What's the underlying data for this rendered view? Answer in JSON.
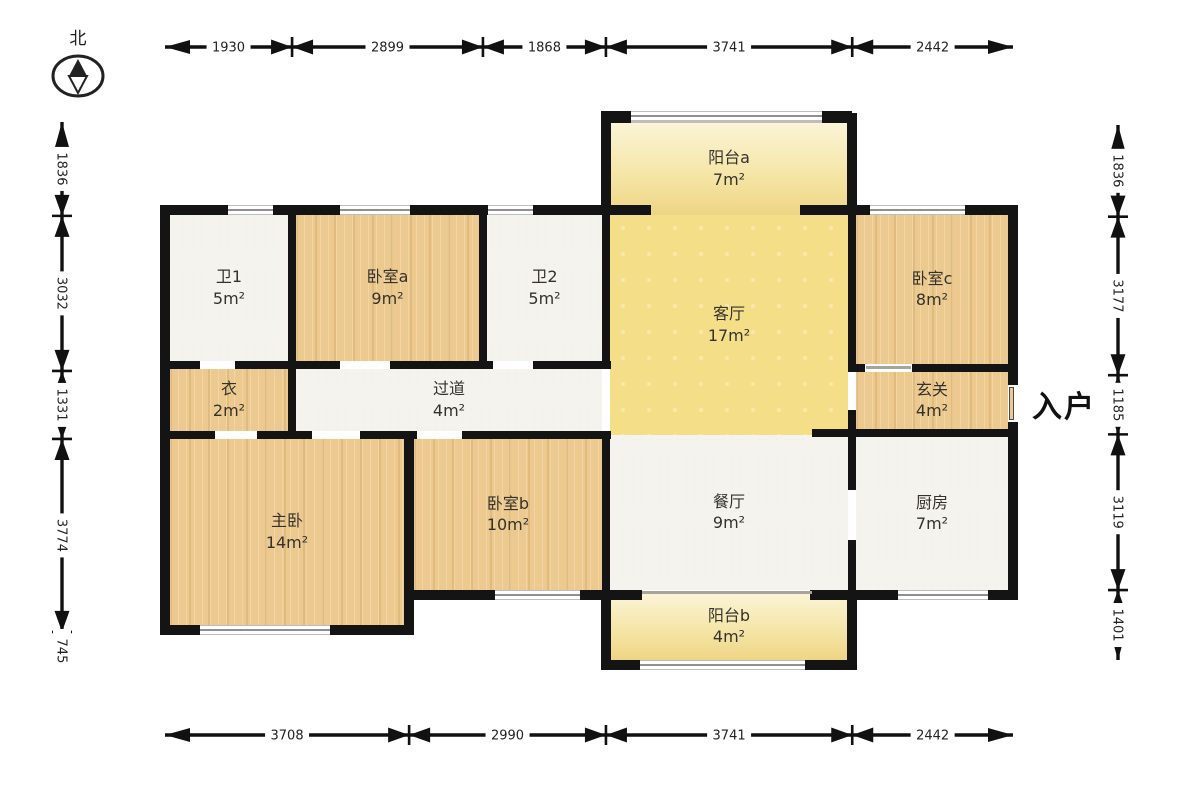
{
  "compass": {
    "label": "北"
  },
  "entry_label": "入户",
  "rooms": [
    {
      "id": "balcony-a",
      "name": "阳台a",
      "area": "7m²",
      "floor": "balcony"
    },
    {
      "id": "bath-1",
      "name": "卫1",
      "area": "5m²",
      "floor": "tile"
    },
    {
      "id": "bedroom-a",
      "name": "卧室a",
      "area": "9m²",
      "floor": "wood"
    },
    {
      "id": "bath-2",
      "name": "卫2",
      "area": "5m²",
      "floor": "tile"
    },
    {
      "id": "living-room",
      "name": "客厅",
      "area": "17m²",
      "floor": "living"
    },
    {
      "id": "bedroom-c",
      "name": "卧室c",
      "area": "8m²",
      "floor": "wood"
    },
    {
      "id": "closet",
      "name": "衣",
      "area": "2m²",
      "floor": "wood"
    },
    {
      "id": "hallway",
      "name": "过道",
      "area": "4m²",
      "floor": "tile"
    },
    {
      "id": "entry-hall",
      "name": "玄关",
      "area": "4m²",
      "floor": "wood"
    },
    {
      "id": "master-bedroom",
      "name": "主卧",
      "area": "14m²",
      "floor": "wood"
    },
    {
      "id": "bedroom-b",
      "name": "卧室b",
      "area": "10m²",
      "floor": "wood"
    },
    {
      "id": "dining-room",
      "name": "餐厅",
      "area": "9m²",
      "floor": "tile"
    },
    {
      "id": "kitchen",
      "name": "厨房",
      "area": "7m²",
      "floor": "tile"
    },
    {
      "id": "balcony-b",
      "name": "阳台b",
      "area": "4m²",
      "floor": "balcony"
    }
  ],
  "dimensions": {
    "top": [
      1930,
      2899,
      1868,
      3741,
      2442
    ],
    "bottom": [
      3708,
      2990,
      3741,
      2442
    ],
    "left": [
      1836,
      3032,
      1331,
      3774,
      745
    ],
    "right": [
      1836,
      3177,
      1185,
      3119,
      1401
    ]
  },
  "colors": {
    "wall": "#141414",
    "wood_floor": "#ecc98e",
    "tile_floor": "#f4f3ee",
    "living_floor": "#f4df88",
    "balcony_floor": "#f5e6a8"
  }
}
